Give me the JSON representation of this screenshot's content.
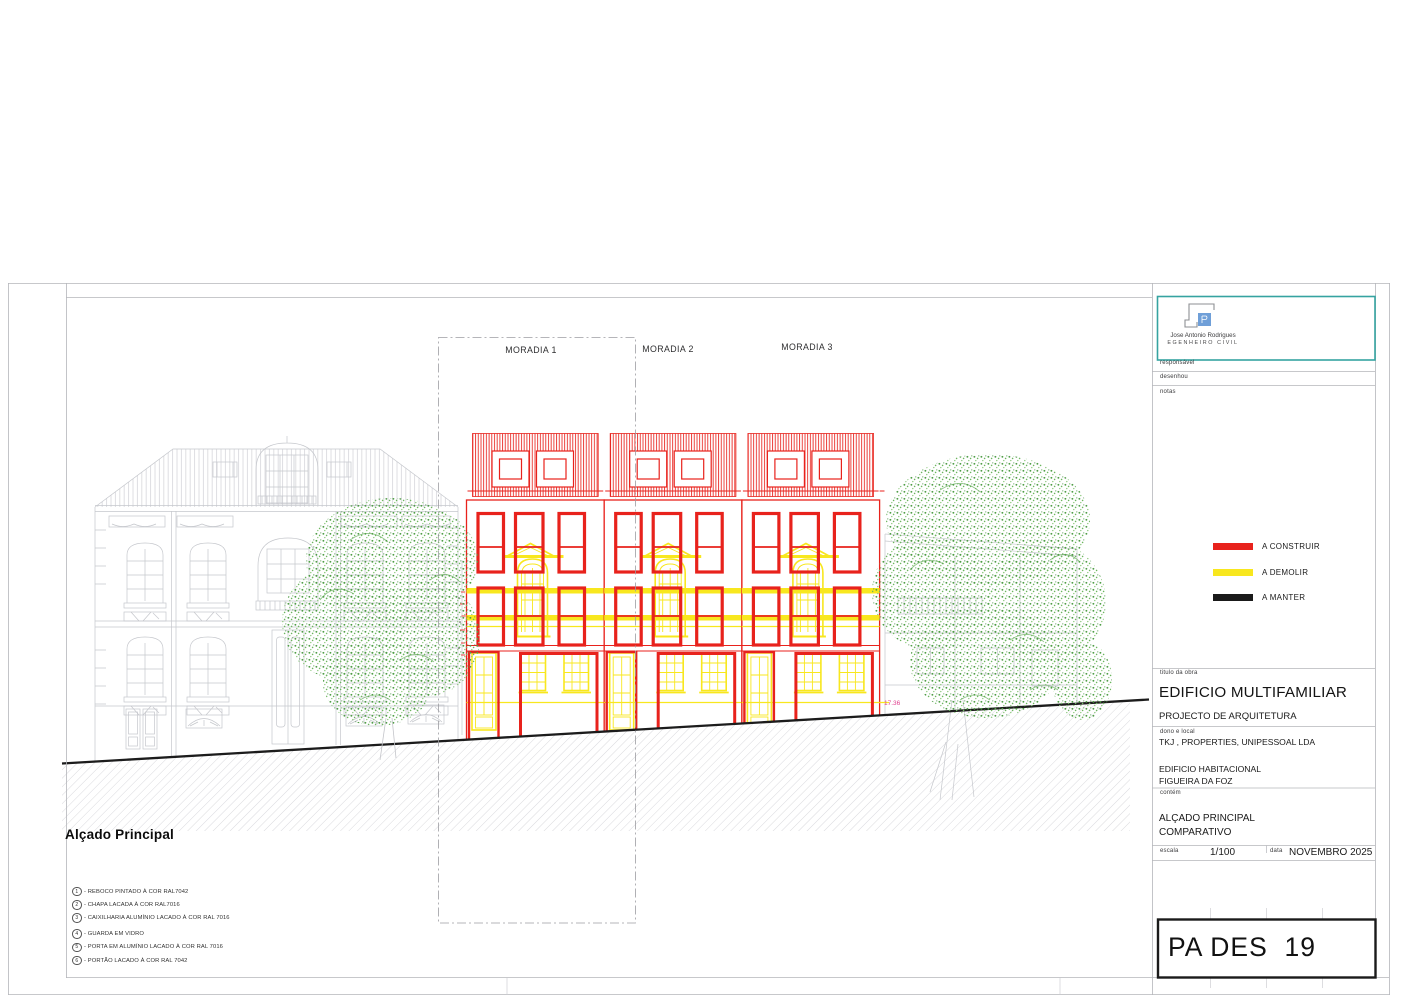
{
  "sheet": {
    "titleblock": {
      "company": {
        "name": "Jose Antonio Rodrigues",
        "role": "EGENHEIRO CIVIL"
      },
      "labels": {
        "responsavel": "responsável",
        "desenhou": "desenhou",
        "notas": "notas",
        "titulo_da_obra": "titulo da obra",
        "dono_e_local": "dono e local",
        "contem": "contém",
        "escala": "escala",
        "data": "data"
      },
      "obra": {
        "title": "EDIFICIO MULTIFAMILIAR",
        "subtitle": "PROJECTO DE ARQUITETURA"
      },
      "dono": {
        "owner": "TKJ , PROPERTIES, UNIPESSOAL LDA",
        "building": "EDIFICIO HABITACIONAL",
        "location": "FIGUEIRA DA FOZ"
      },
      "contem_content": {
        "line1": "ALÇADO PRINCIPAL",
        "line2": "COMPARATIVO"
      },
      "escala_value": "1/100",
      "data_value": "NOVEMBRO 2025",
      "sheet_code": "PA DES  19",
      "legend": [
        {
          "label": "A CONSTRUIR",
          "color": "#e8221c"
        },
        {
          "label": "A DEMOLIR",
          "color": "#f8e71e"
        },
        {
          "label": "A MANTER",
          "color": "#1a1a1a"
        }
      ]
    },
    "drawing": {
      "elevation_title": "Alçado Principal",
      "unit_labels": [
        "MORADIA 1",
        "MORADIA 2",
        "MORADIA 3"
      ],
      "level_label": "17.36",
      "notes": [
        {
          "num": "1",
          "text": "- REBOCO PINTADO À COR RAL7042"
        },
        {
          "num": "2",
          "text": "- CHAPA LACADA À COR RAL7016"
        },
        {
          "num": "3",
          "text": "- CAIXILHARIA ALUMÍNIO LACADO À COR RAL 7016"
        },
        {
          "num": "4",
          "text": "- GUARDA EM VIDRO"
        },
        {
          "num": "5",
          "text": "- PORTA EM ALUMÍNIO LACADO À COR RAL 7016"
        },
        {
          "num": "6",
          "text": "- PORTÃO LACADO À COR RAL 7042"
        }
      ]
    },
    "colors": {
      "to_build": "#e8221c",
      "to_demolish": "#f8e71e",
      "to_keep": "#1a1a1a",
      "existing": "#c5c7cc",
      "foliage": "#4f9d46",
      "frame_teal": "#35a3a1",
      "level_text": "#e0418f"
    }
  }
}
